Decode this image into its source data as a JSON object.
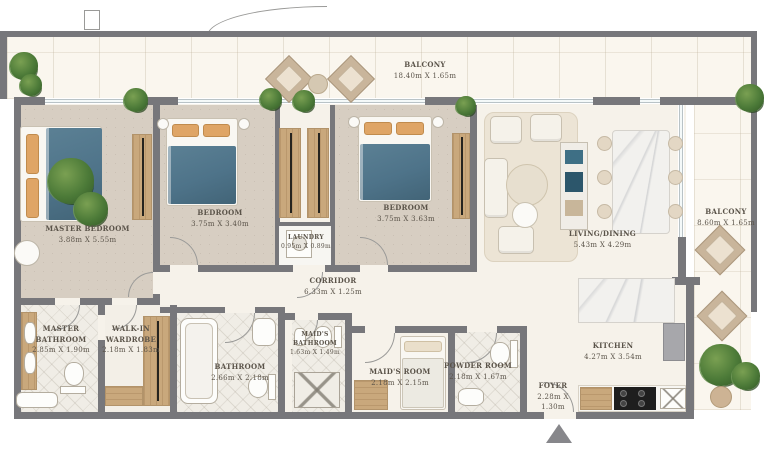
{
  "rooms": {
    "balcony_top": {
      "name": "BALCONY",
      "dims": "18.40m X 1.65m"
    },
    "master_bedroom": {
      "name": "MASTER BEDROOM",
      "dims": "3.88m X 5.55m"
    },
    "bedroom_2": {
      "name": "BEDROOM",
      "dims": "3.75m X 3.40m"
    },
    "bedroom_3": {
      "name": "BEDROOM",
      "dims": "3.75m X 3.63m"
    },
    "laundry": {
      "name": "LAUNDRY",
      "dims": "0.95m X 0.89m"
    },
    "living_dining": {
      "name": "LIVING/DINING",
      "dims": "5.43m X 4.29m"
    },
    "balcony_right": {
      "name": "BALCONY",
      "dims": "8.60m X 1.65m"
    },
    "corridor": {
      "name": "CORRIDOR",
      "dims": "6.33m X 1.25m"
    },
    "master_bathroom": {
      "name": "MASTER BATHROOM",
      "dims": "2.85m X 1.90m"
    },
    "walk_in_wardrobe": {
      "name": "WALK-IN WARDROBE",
      "dims": "2.18m X 1.83m"
    },
    "bathroom": {
      "name": "BATHROOM",
      "dims": "2.66m X 2.18m"
    },
    "maids_bathroom": {
      "name": "MAID'S BATHROOM",
      "dims": "1.63m X 1.49m"
    },
    "maids_room": {
      "name": "MAID'S ROOM",
      "dims": "2.18m X 2.15m"
    },
    "powder_room": {
      "name": "POWDER ROOM",
      "dims": "2.18m X 1.67m"
    },
    "kitchen": {
      "name": "KITCHEN",
      "dims": "4.27m X 3.54m"
    },
    "foyer": {
      "name": "FOYER",
      "dims": "2.28m X 1.30m"
    }
  },
  "colors": {
    "wall": "#77777b",
    "floor": "#f6f2ea",
    "carpet": "#d7cec2",
    "tile": "#f0ede6",
    "balcony-floor": "#faf6ee",
    "blanket": "#4e7389",
    "pillow": "#dfa566",
    "wood": "#c9a87c",
    "plant": "#4c7a38",
    "window": "#b9c3c7",
    "label-text": "#5a5349"
  }
}
